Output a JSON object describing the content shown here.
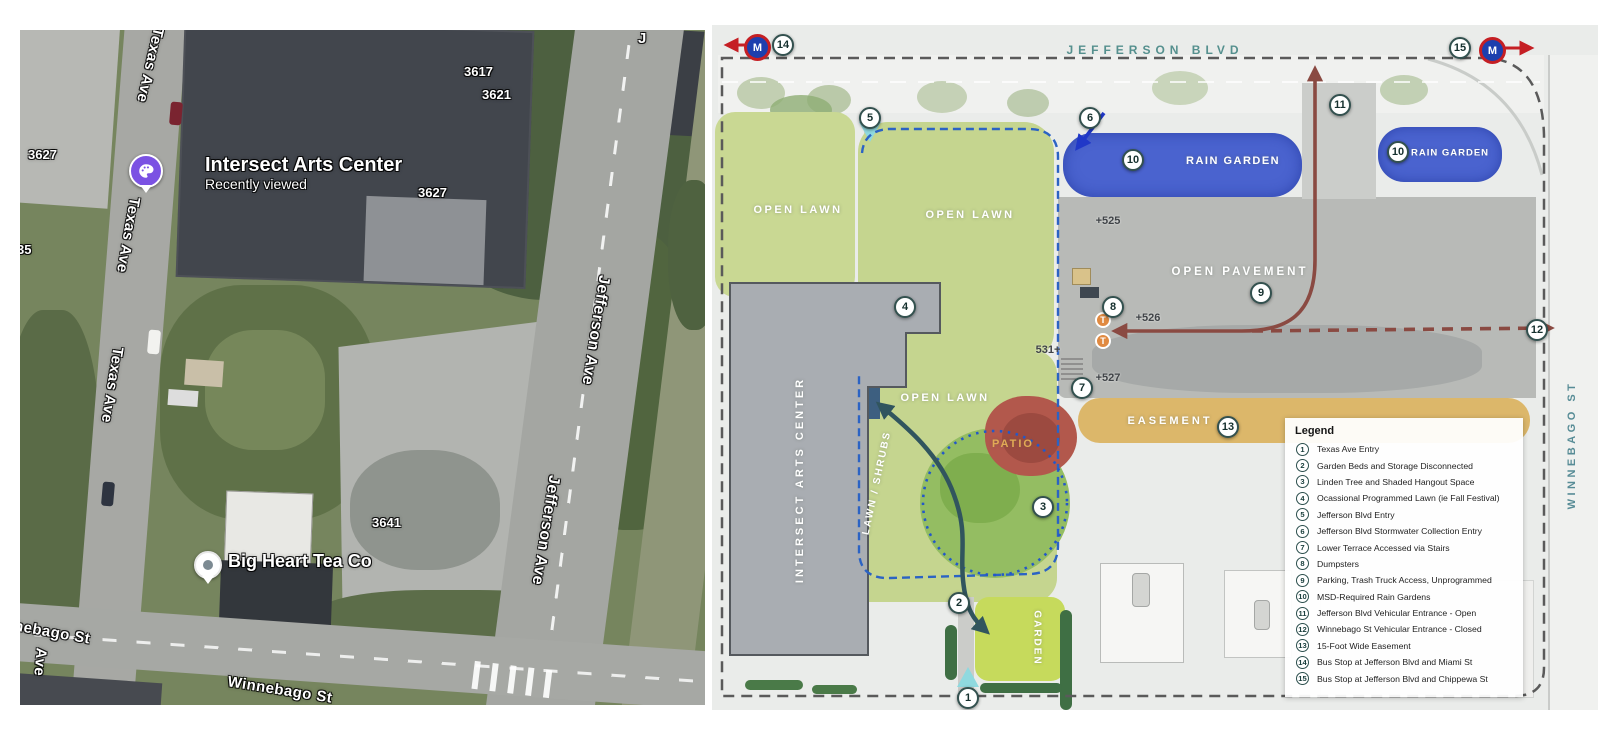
{
  "colors": {
    "rain_garden_blue": "#4a63cf",
    "easement_tan": "#dcb76a",
    "route_maroon": "#8a4a42",
    "path_teal": "#31555e",
    "lawn_green": "#c9d893",
    "canopy_green": "#94bd62",
    "garden_green": "#c6da5c",
    "entry_cyan": "#8fd9df",
    "metro_blue": "#1d3fae",
    "metro_red": "#c51f24",
    "boundary_blue_dash": "#2b63c4",
    "street_teal_text": "#55908e"
  },
  "left_map": {
    "streets": {
      "texas_top": "Texas Ave",
      "texas_mid": "Texas Ave",
      "texas_low": "Texas Ave",
      "jefferson_up": "Jefferson Ave",
      "jefferson_low": "Jefferson Ave",
      "winnebago_cut": "Winnebago St",
      "winnebago": "Winnebago St",
      "ave": "Ave",
      "j": "J"
    },
    "addresses": {
      "a3617": "3617",
      "a3621": "3621",
      "a3627r": "3627",
      "a3627l": "3627",
      "a35": "35",
      "a3641": "3641"
    },
    "pois": {
      "intersect": {
        "title": "Intersect Arts Center",
        "subtitle": "Recently viewed"
      },
      "bigheart": {
        "title": "Big Heart Tea Co"
      }
    }
  },
  "plan": {
    "streets": {
      "top": "JEFFERSON BLVD",
      "right": "WINNEBAGO ST"
    },
    "labels": {
      "open_lawn": "OPEN LAWN",
      "rain_garden": "RAIN GARDEN",
      "open_pavement": "OPEN PAVEMENT",
      "patio": "PATIO",
      "garden": "GARDEN",
      "easement": "EASEMENT",
      "lawn_shrubs": "LAWN / SHRUBS",
      "building": "INTERSECT ARTS CENTER"
    },
    "elevations": {
      "e525": "+525",
      "e526": "+526",
      "e531": "531+",
      "e527": "+527"
    },
    "metro": "M",
    "trash": "T",
    "markers": {
      "m1": "1",
      "m2": "2",
      "m3": "3",
      "m4": "4",
      "m5": "5",
      "m6": "6",
      "m7": "7",
      "m8": "8",
      "m9": "9",
      "m10": "10",
      "m11": "11",
      "m12": "12",
      "m13": "13",
      "m14": "14",
      "m15": "15"
    },
    "legend": {
      "title": "Legend",
      "items": [
        {
          "n": "1",
          "t": "Texas Ave Entry"
        },
        {
          "n": "2",
          "t": "Garden Beds and Storage Disconnected"
        },
        {
          "n": "3",
          "t": "Linden Tree and Shaded Hangout Space"
        },
        {
          "n": "4",
          "t": "Ocassional Programmed Lawn (ie Fall Festival)"
        },
        {
          "n": "5",
          "t": "Jefferson Blvd Entry"
        },
        {
          "n": "6",
          "t": "Jefferson Blvd Stormwater Collection Entry"
        },
        {
          "n": "7",
          "t": "Lower Terrace Accessed via Stairs"
        },
        {
          "n": "8",
          "t": "Dumpsters"
        },
        {
          "n": "9",
          "t": "Parking, Trash Truck Access, Unprogrammed"
        },
        {
          "n": "10",
          "t": "MSD-Required Rain Gardens"
        },
        {
          "n": "11",
          "t": "Jefferson Blvd Vehicular Entrance - Open"
        },
        {
          "n": "12",
          "t": "Winnebago St Vehicular Entrance - Closed"
        },
        {
          "n": "13",
          "t": "15-Foot Wide Easement"
        },
        {
          "n": "14",
          "t": "Bus Stop at Jefferson Blvd and Miami St"
        },
        {
          "n": "15",
          "t": "Bus Stop at Jefferson Blvd and Chippewa St"
        }
      ]
    }
  }
}
